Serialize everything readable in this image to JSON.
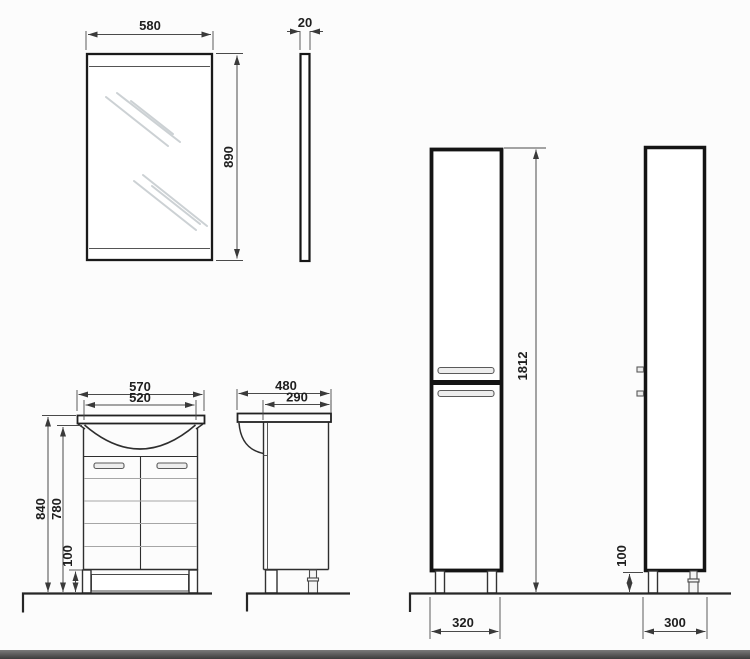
{
  "page": {
    "background": "#fcfcfc",
    "ink": "#1f1f1f",
    "outline_color": "#2e2e2e",
    "dim_line_color": "#4a4a4a",
    "shine_color": "#ccd1d4",
    "footer_bar_color": "#4a4a4a"
  },
  "dimensions": {
    "mirror_front": {
      "width": "580",
      "height": "890"
    },
    "mirror_side": {
      "thickness": "20"
    },
    "vanity_front": {
      "overall_width": "570",
      "basin_width": "520",
      "overall_height": "840",
      "body_height": "780",
      "leg_height": "100"
    },
    "vanity_side": {
      "overall_depth": "480",
      "body_depth": "290"
    },
    "tall_cabinet_front": {
      "height": "1812",
      "width": "320"
    },
    "tall_cabinet_side": {
      "depth": "300",
      "leg_height": "100"
    }
  }
}
